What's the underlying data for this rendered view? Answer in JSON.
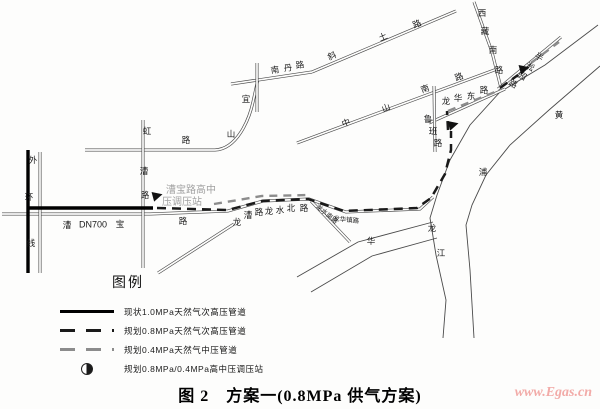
{
  "figure": {
    "caption": "图 2　方案一(0.8MPa 供气方案)",
    "watermark": "www.Egas.cn"
  },
  "legend": {
    "heading": "图例",
    "items": [
      {
        "style": "solid-black",
        "label": "现状1.0MPa天然气次高压管道"
      },
      {
        "style": "dashed-black",
        "label": "规划0.8MPa天然气次高压管道"
      },
      {
        "style": "dashed-gray",
        "label": "规划0.4MPa天然气中压管道"
      },
      {
        "style": "station-symbol",
        "label": "规划0.8MPa/0.4MPa高中压调压站"
      }
    ]
  },
  "colors": {
    "road": "#4a4a4a",
    "river": "#4a4a4a",
    "existing_pipeline": "#000000",
    "planned_08_pipeline": "#1a1a1a",
    "planned_04_pipeline": "#8c8c8c",
    "station": "#111111",
    "gray_text": "#a0a0a0",
    "watermark": "#f2aba8"
  },
  "map": {
    "roads": [
      {
        "name": "caobao-road",
        "d": "M 2 214 L 150 214"
      },
      {
        "name": "longcao-longshui-road",
        "d": "M 150 214 L 228 211 L 263 201 L 309 199 L 346 212 L 420 209 L 433 197"
      },
      {
        "name": "yishan-road",
        "d": "M 85 150 L 215 150 C 237 149 249 120 253 102 L 258 79"
      },
      {
        "name": "hongcao-road",
        "d": "M 143 120 L 143 268"
      },
      {
        "name": "outer-ring-road",
        "d": "M 40 152 L 40 273"
      },
      {
        "name": "nandan-road",
        "d": "M 231 84 L 312 72"
      },
      {
        "name": "unnamed-north-road",
        "d": "M 257 63 L 257 112"
      },
      {
        "name": "xietu-road",
        "d": "M 312 72 L 456 11"
      },
      {
        "name": "zhongshan-south-road",
        "d": "M 297 143 L 497 69"
      },
      {
        "name": "longhua-east-road",
        "d": "M 429 123 L 505 89"
      },
      {
        "name": "luban-road",
        "d": "M 434 86 L 435 152"
      },
      {
        "name": "xizang-south-road",
        "d": "M 474 2 L 492 52 L 501 88"
      },
      {
        "name": "bansongyuan-road",
        "d": "M 498 89 L 561 37"
      },
      {
        "name": "southwest-branch-road",
        "d": "M 234 224 L 158 273"
      },
      {
        "name": "longshui-south-road",
        "d": "M 311 201 L 350 242"
      }
    ],
    "waterways": [
      {
        "name": "huangpu-river-bank-1",
        "d": "M 598 25 L 545 65 L 500 92 L 470 125 L 450 160 L 437 195 L 430 218 L 436 255 L 446 300 L 443 338"
      },
      {
        "name": "huangpu-river-bank-2",
        "d": "M 600 66 L 549 110 L 510 145 L 486 175 L 472 205 L 466 225 L 470 270 L 474 338"
      },
      {
        "name": "creek-bank-1",
        "d": "M 297 277 L 358 242 L 433 222"
      },
      {
        "name": "creek-bank-2",
        "d": "M 311 292 L 372 256 L 437 238"
      }
    ],
    "pipelines": {
      "existing_high_pressure": [
        "M 28 150 L 28 273",
        "M 29 208 L 153 208"
      ],
      "planned_08": [
        "M 157 208 L 228 210 L 262 201 L 308 199 L 344 211 L 417 208 L 431 198 L 445 174 L 451 150 L 451 131",
        "M 448 130 L 447 111",
        "M 500 88 L 518 75"
      ],
      "planned_04": [
        "M 214 204 L 262 196 L 310 195",
        "M 448 111 L 500 90",
        "M 531 63 L 559 42"
      ]
    },
    "stations": [
      {
        "name": "caobao-road-station",
        "x": 156,
        "y": 197
      },
      {
        "name": "luban-road-station",
        "x": 452,
        "y": 126
      },
      {
        "name": "bansongyuan-station",
        "x": 523,
        "y": 70
      }
    ],
    "labels": [
      {
        "g": "outer-ring-label",
        "t": "外",
        "x": 33,
        "y": 160
      },
      {
        "g": "outer-ring-label",
        "t": "环",
        "x": 29,
        "y": 197
      },
      {
        "g": "outer-ring-label",
        "t": "线",
        "x": 31,
        "y": 243
      },
      {
        "g": "hongcao-road-label",
        "t": "虹",
        "x": 147,
        "y": 131
      },
      {
        "g": "hongcao-road-label",
        "t": "漕",
        "x": 144,
        "y": 171
      },
      {
        "g": "hongcao-road-label",
        "t": "路",
        "x": 145,
        "y": 195
      },
      {
        "g": "yishan-road-label",
        "t": "宜",
        "x": 246,
        "y": 99
      },
      {
        "g": "yishan-road-label",
        "t": "山",
        "x": 231,
        "y": 134
      },
      {
        "g": "yishan-road-label",
        "t": "路",
        "x": 186,
        "y": 140
      },
      {
        "g": "nandan-road-label",
        "t": "南",
        "x": 275,
        "y": 70,
        "r": -8
      },
      {
        "g": "nandan-road-label",
        "t": "丹",
        "x": 288,
        "y": 68,
        "r": -8
      },
      {
        "g": "nandan-road-label",
        "t": "路",
        "x": 300,
        "y": 65,
        "r": -8
      },
      {
        "g": "xietu-road-label",
        "t": "斜",
        "x": 332,
        "y": 56,
        "r": -23
      },
      {
        "g": "xietu-road-label",
        "t": "土",
        "x": 383,
        "y": 37,
        "r": -23
      },
      {
        "g": "xietu-road-label",
        "t": "路",
        "x": 417,
        "y": 24,
        "r": -23
      },
      {
        "g": "zhongshan-south-road-label",
        "t": "中",
        "x": 346,
        "y": 123,
        "r": -20
      },
      {
        "g": "zhongshan-south-road-label",
        "t": "山",
        "x": 386,
        "y": 108,
        "r": -20
      },
      {
        "g": "zhongshan-south-road-label",
        "t": "南",
        "x": 425,
        "y": 89,
        "r": -20
      },
      {
        "g": "zhongshan-south-road-label",
        "t": "路",
        "x": 459,
        "y": 77,
        "r": -20
      },
      {
        "g": "caobao-road-label",
        "t": "漕",
        "x": 67,
        "y": 225
      },
      {
        "g": "dn700-label",
        "t": "DN700",
        "x": 93,
        "y": 225,
        "s": 9
      },
      {
        "g": "caobao-road-label",
        "t": "宝",
        "x": 120,
        "y": 224
      },
      {
        "g": "caobao-road-label",
        "t": "路",
        "x": 183,
        "y": 221
      },
      {
        "g": "longcao-road-label",
        "t": "龙",
        "x": 237,
        "y": 222
      },
      {
        "g": "longcao-road-label",
        "t": "漕",
        "x": 248,
        "y": 215
      },
      {
        "g": "longcao-road-label",
        "t": "路",
        "x": 259,
        "y": 212
      },
      {
        "g": "longshui-north-road-label",
        "t": "龙",
        "x": 269,
        "y": 211
      },
      {
        "g": "longshui-north-road-label",
        "t": "水",
        "x": 280,
        "y": 210
      },
      {
        "g": "longshui-north-road-label",
        "t": "北",
        "x": 291,
        "y": 208
      },
      {
        "g": "longshui-north-road-label",
        "t": "路",
        "x": 304,
        "y": 208
      },
      {
        "g": "longshui-south-road-label",
        "t": "龙水南路",
        "x": 326,
        "y": 215,
        "r": 40,
        "s": 6.5
      },
      {
        "g": "longhua-zhen-road-label",
        "t": "龙华镇路",
        "x": 346,
        "y": 221,
        "r": 6,
        "s": 6.5
      },
      {
        "g": "longhua-east-road-label",
        "t": "龙",
        "x": 446,
        "y": 101
      },
      {
        "g": "longhua-east-road-label",
        "t": "华",
        "x": 458,
        "y": 98
      },
      {
        "g": "longhua-east-road-label",
        "t": "东",
        "x": 471,
        "y": 96
      },
      {
        "g": "longhua-east-road-label",
        "t": "路",
        "x": 484,
        "y": 90
      },
      {
        "g": "luban-road-label",
        "t": "鲁",
        "x": 428,
        "y": 119
      },
      {
        "g": "luban-road-label",
        "t": "班",
        "x": 433,
        "y": 131
      },
      {
        "g": "luban-road-label",
        "t": "路",
        "x": 438,
        "y": 143
      },
      {
        "g": "xizang-south-road-label",
        "t": "西",
        "x": 482,
        "y": 13
      },
      {
        "g": "xizang-south-road-label",
        "t": "藏",
        "x": 485,
        "y": 31
      },
      {
        "g": "xizang-south-road-label",
        "t": "南",
        "x": 493,
        "y": 50
      },
      {
        "g": "xizang-south-road-label",
        "t": "路",
        "x": 499,
        "y": 70
      },
      {
        "g": "bansongyuan-road-label",
        "t": "半",
        "x": 539,
        "y": 57,
        "r": 30
      },
      {
        "g": "bansongyuan-road-label",
        "t": "淞",
        "x": 530,
        "y": 67,
        "r": 30
      },
      {
        "g": "bansongyuan-road-label",
        "t": "园",
        "x": 522,
        "y": 76,
        "r": 30
      },
      {
        "g": "bansongyuan-road-label",
        "t": "路",
        "x": 513,
        "y": 84,
        "r": 30
      },
      {
        "g": "huangpu-river-label",
        "t": "黄",
        "x": 559,
        "y": 115
      },
      {
        "g": "huangpu-river-label",
        "t": "浦",
        "x": 483,
        "y": 172
      },
      {
        "g": "huangpu-river-label",
        "t": "江",
        "x": 441,
        "y": 253
      },
      {
        "g": "longhua-label",
        "t": "龙",
        "x": 432,
        "y": 228
      },
      {
        "g": "longhua-label",
        "t": "华",
        "x": 371,
        "y": 241
      },
      {
        "g": "caobao-station-label",
        "t": "漕宝路高中",
        "x": 191,
        "y": 191,
        "s": 10,
        "c": "#a0a0a0"
      },
      {
        "g": "caobao-station-label",
        "t": "压调压站",
        "x": 182,
        "y": 203,
        "s": 10,
        "c": "#a0a0a0"
      }
    ]
  }
}
